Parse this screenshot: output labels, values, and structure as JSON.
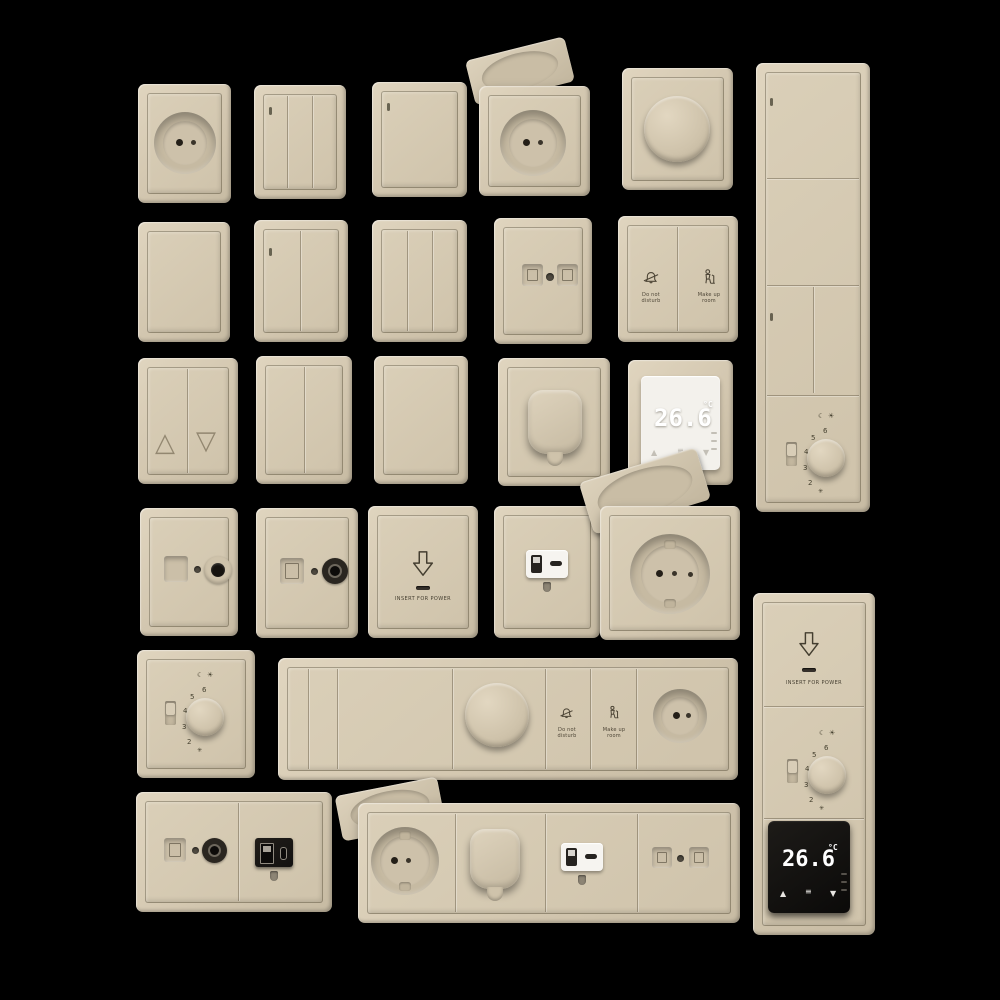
{
  "scene": {
    "background": "#000000",
    "description": "3D render catalog of beige hotel electrical fittings: rocker switches, sockets, dimmers, card holders, thermostats"
  },
  "colors": {
    "plate": "#d5c9b2",
    "plate_light": "#e0d5bf",
    "plate_dark": "#b5a98f",
    "engraving": "#4d4536",
    "white_module": "#f3f1ec",
    "black_module": "#141210",
    "digit": "#ffffff"
  },
  "labels": {
    "do_not_line1": "Do not",
    "do_not_line2": "disturb",
    "make_up_line1": "Make up",
    "make_up_line2": "room",
    "insert_for_power": "INSERT FOR POWER"
  },
  "thermostat_display": {
    "temp": "26.6",
    "unit": "°C",
    "up_arrow": "▲",
    "down_arrow": "▼",
    "menu_icon": "≡"
  },
  "dial": {
    "n2": "2",
    "n3": "3",
    "n4": "4",
    "n5": "5",
    "n6": "6",
    "moon": "☾",
    "sun": "☀",
    "frost": "✳"
  },
  "blind_switch": {
    "up": "△",
    "down": "▽"
  }
}
